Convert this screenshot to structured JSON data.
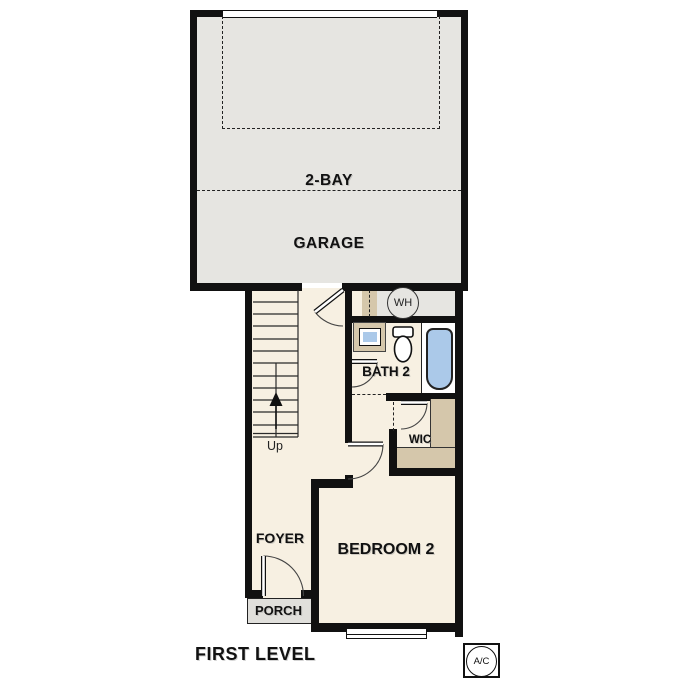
{
  "floorplan": {
    "level_title": "FIRST LEVEL",
    "rooms": {
      "garage": {
        "label_line1": "2-BAY",
        "label_line2": "GARAGE"
      },
      "bath2": {
        "label": "BATH 2"
      },
      "wic": {
        "label": "WIC"
      },
      "bedroom2": {
        "label": "BEDROOM 2"
      },
      "foyer": {
        "label": "FOYER"
      },
      "porch": {
        "label": "PORCH"
      }
    },
    "annotations": {
      "stairs_direction": "Up",
      "water_heater": "WH",
      "ac_unit": "A/C"
    },
    "colors": {
      "wall": "#111111",
      "garage_floor": "#e6e5e1",
      "living_floor": "#f7f0e2",
      "cabinetry_tan": "#d5c7ab",
      "fixture_blue": "#abc9e9",
      "porch_gray": "#e0dfdb"
    }
  }
}
